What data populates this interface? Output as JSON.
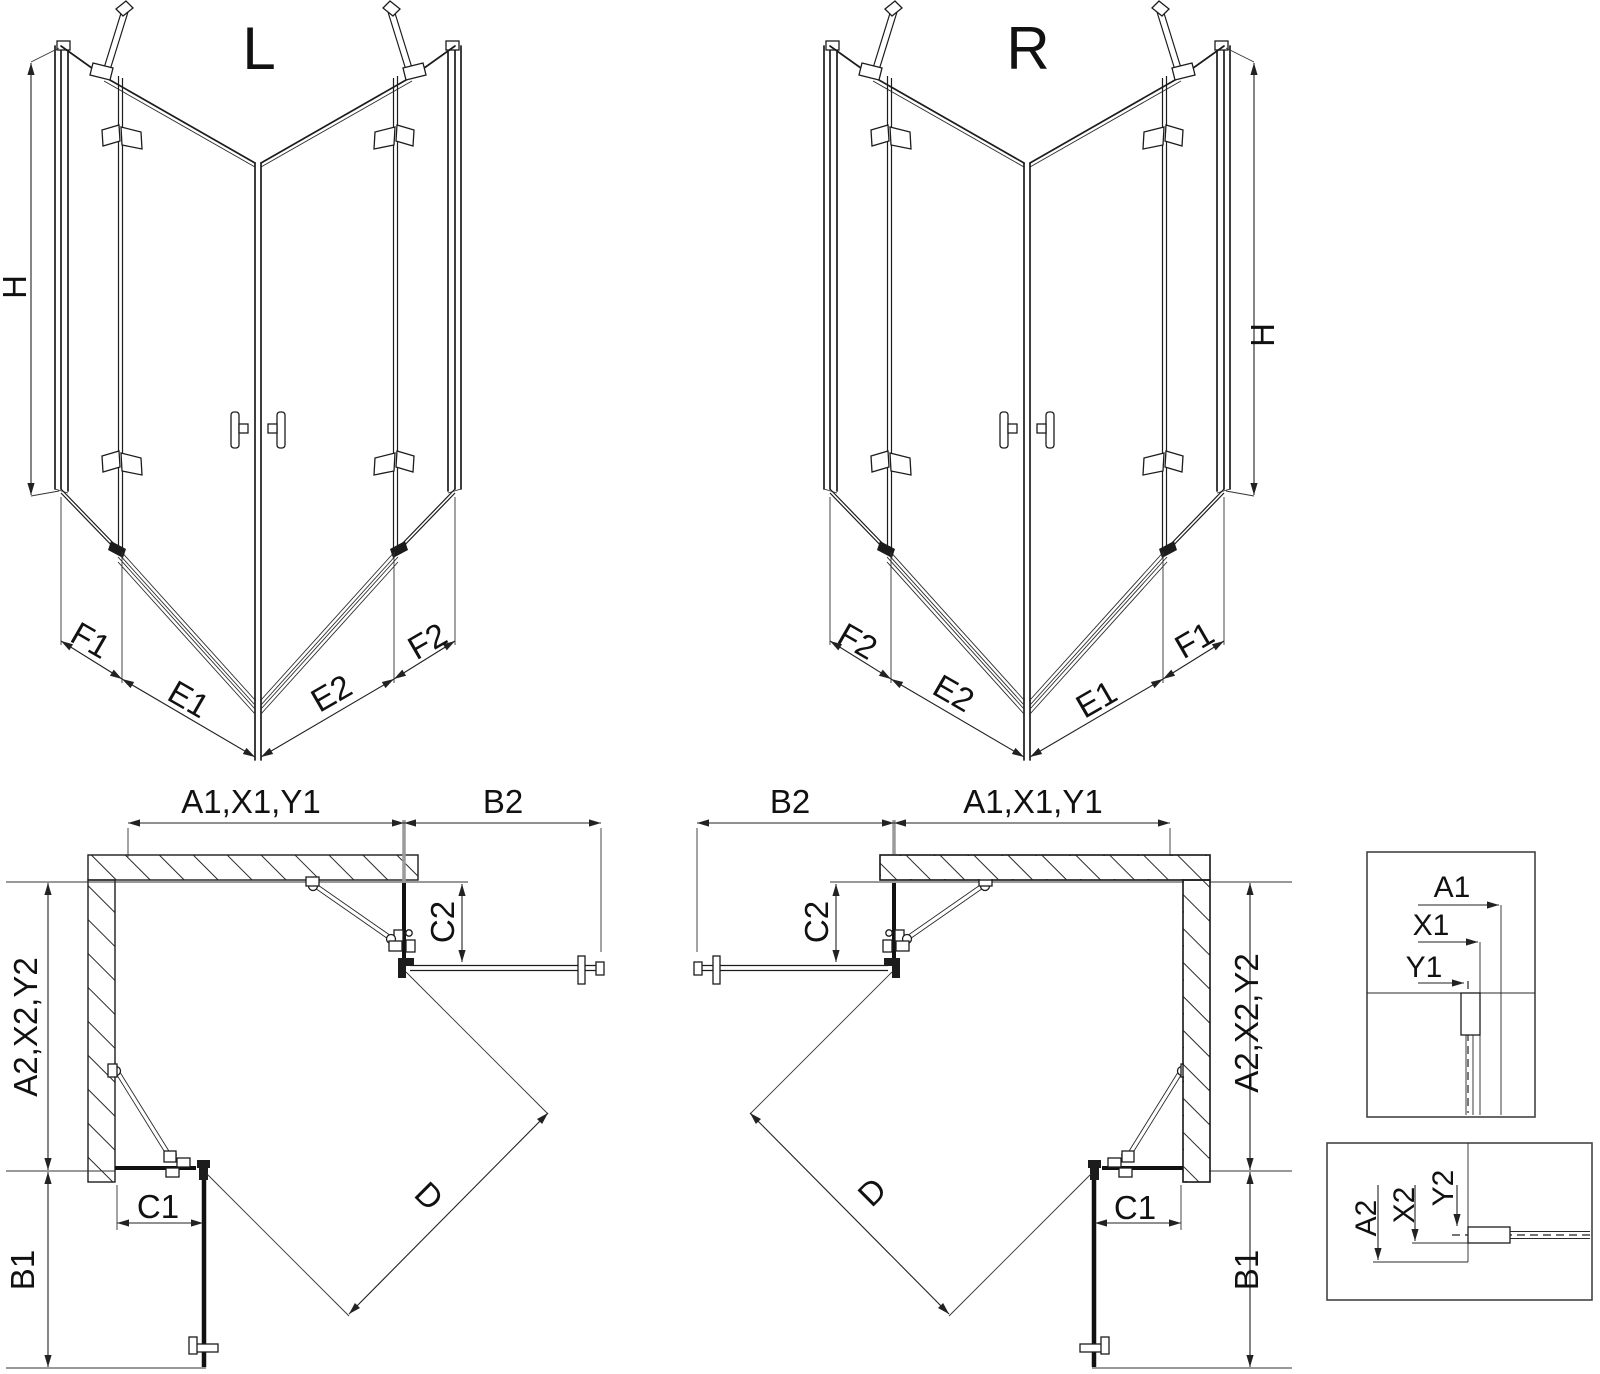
{
  "drawing": {
    "type": "technical-dimension-diagram",
    "subject": "corner shower enclosure, left (L) and right (R) versions: perspective views, plan views and wall-profile detail callouts",
    "colors": {
      "ink": "#1c1c1c",
      "background": "#ffffff",
      "extension_gray": "#9b9b9b"
    }
  },
  "labels": {
    "left3d": {
      "title": "L",
      "h": "H",
      "f1": "F1",
      "e1": "E1",
      "e2": "E2",
      "f2": "F2"
    },
    "right3d": {
      "title": "R",
      "h": "H",
      "f1": "F1",
      "e1": "E1",
      "e2": "E2",
      "f2": "F2"
    },
    "left_plan": {
      "a1": "A1,X1,Y1",
      "b2": "B2",
      "c2": "C2",
      "a2": "A2,X2,Y2",
      "b1": "B1",
      "c1": "C1",
      "d": "D"
    },
    "right_plan": {
      "a1": "A1,X1,Y1",
      "b2": "B2",
      "c2": "C2",
      "a2": "A2,X2,Y2",
      "b1": "B1",
      "c1": "C1",
      "d": "D"
    },
    "detail_top": {
      "a1": "A1",
      "x1": "X1",
      "y1": "Y1"
    },
    "detail_bottom": {
      "a2": "A2",
      "x2": "X2",
      "y2": "Y2"
    }
  }
}
